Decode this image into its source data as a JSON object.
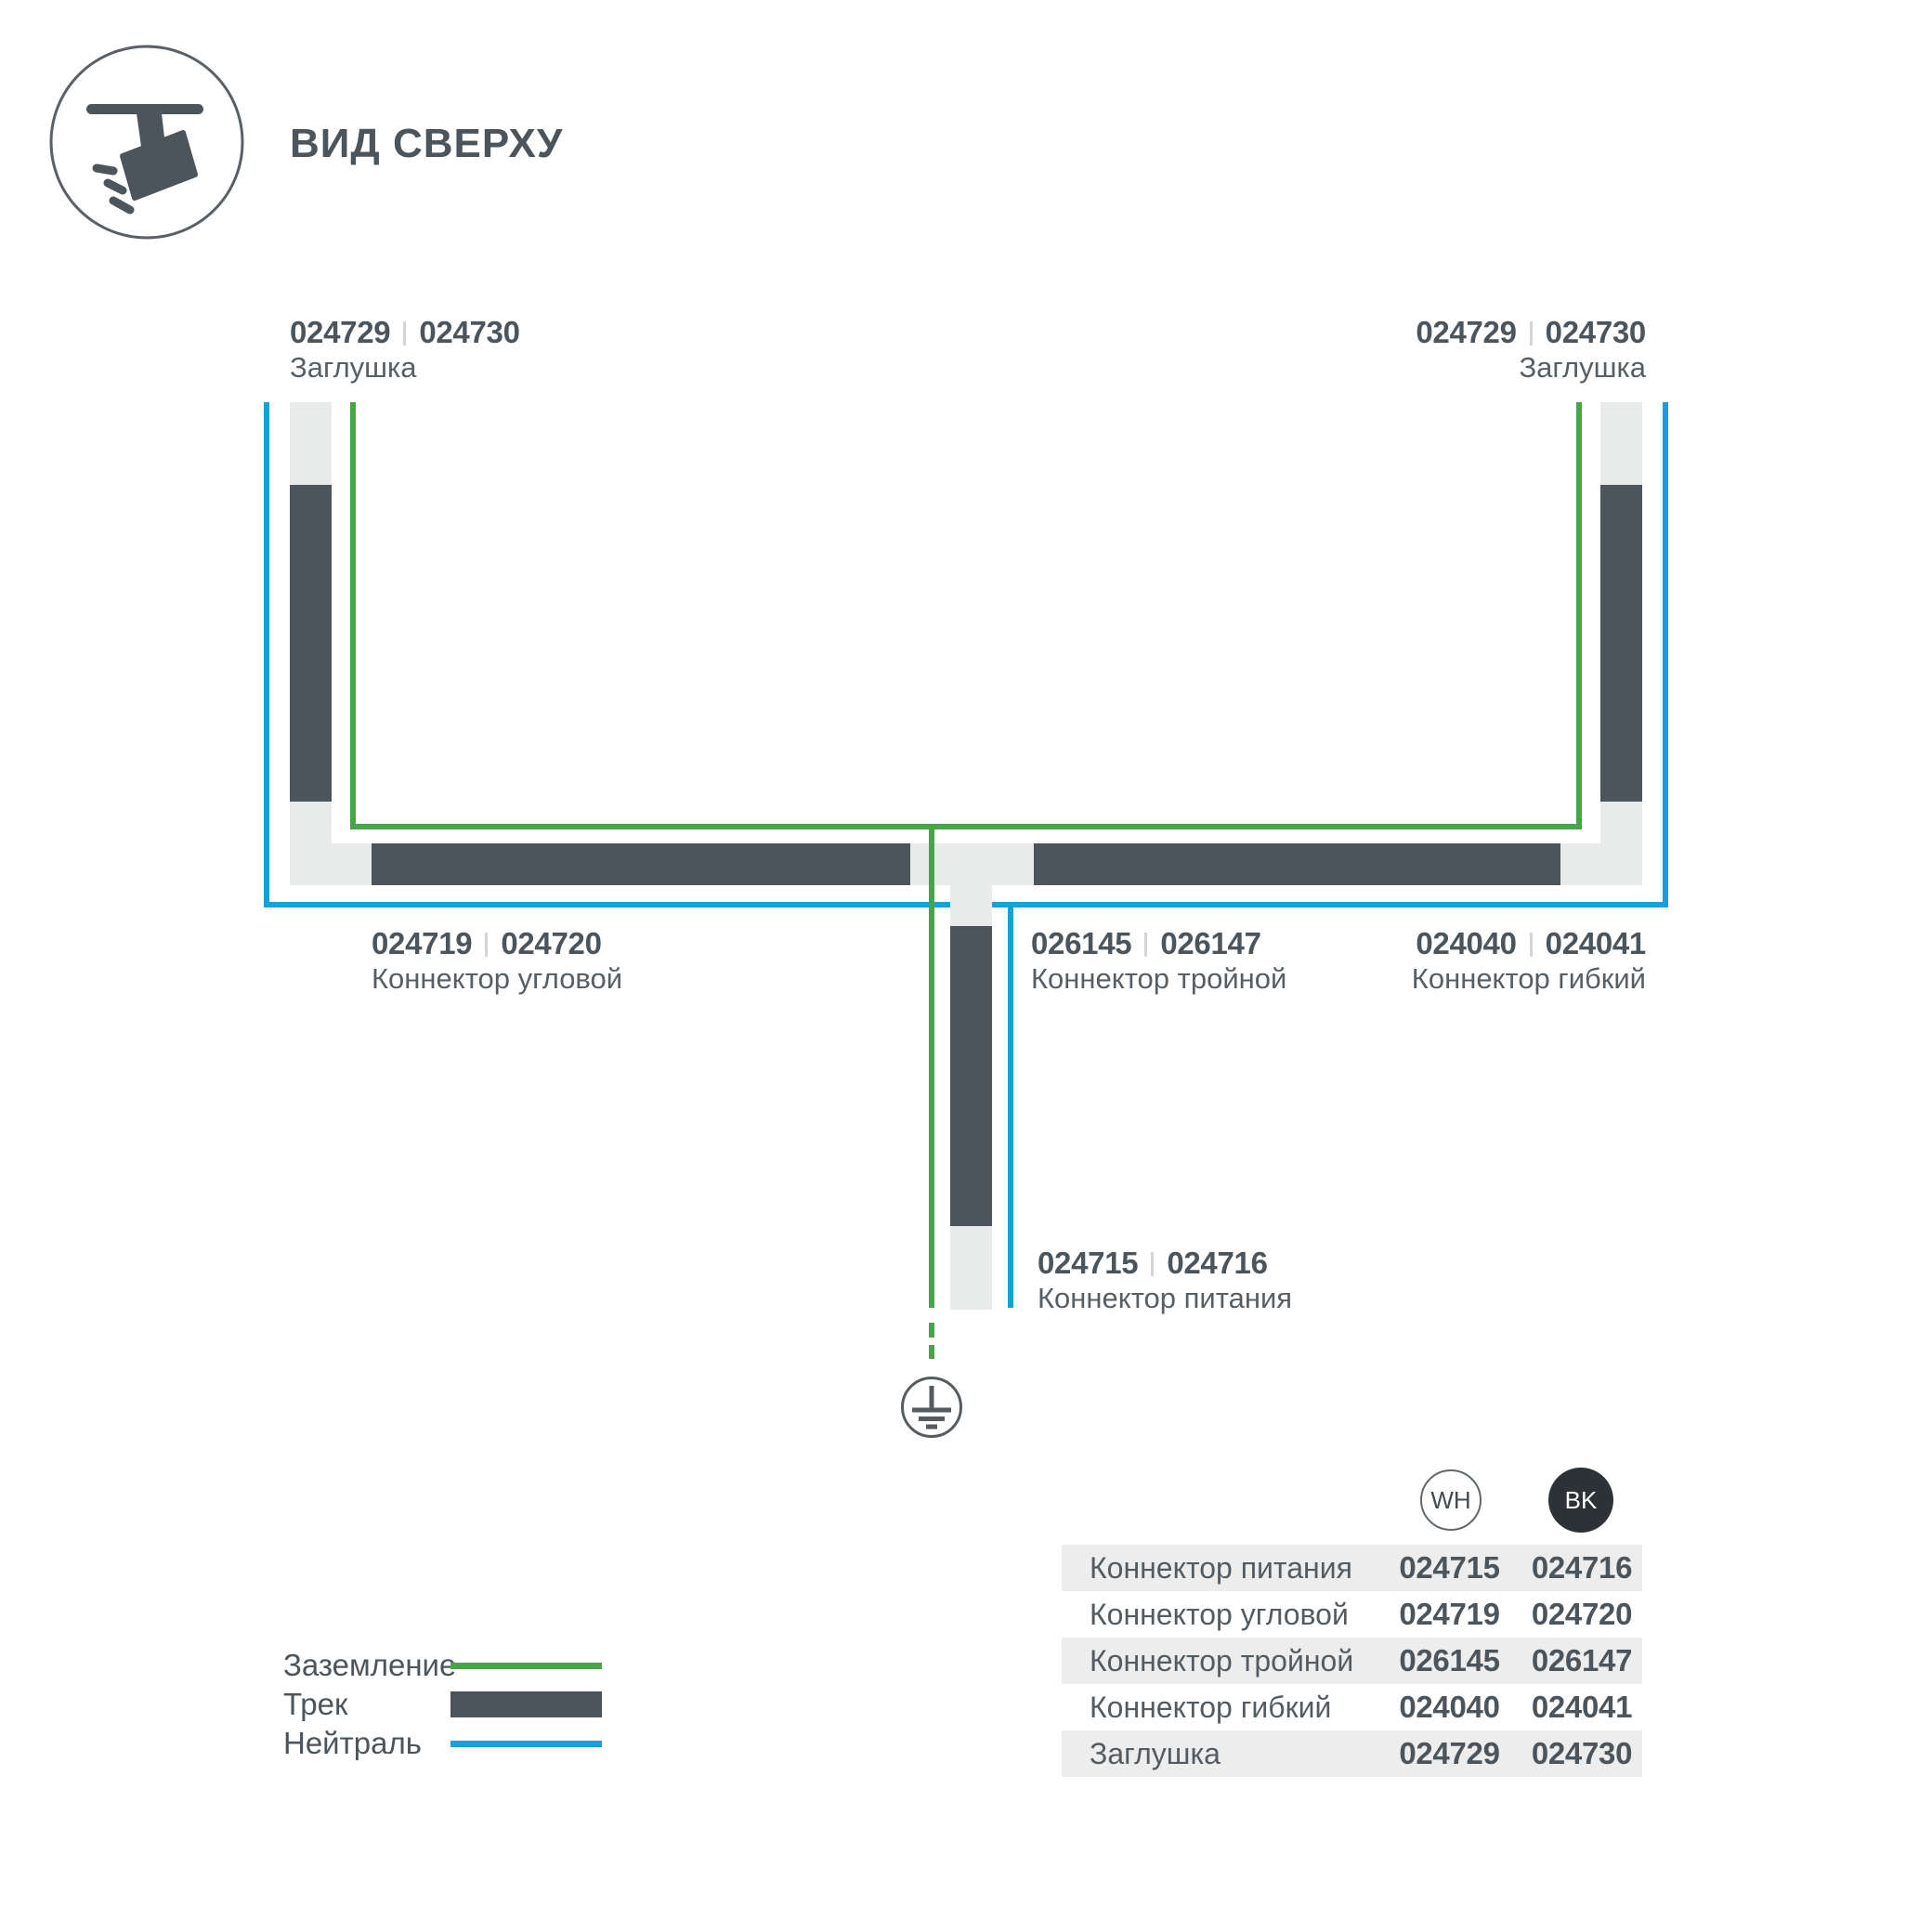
{
  "header": {
    "title": "ВИД СВЕРХУ",
    "icon": "track-spotlight-icon"
  },
  "diagram": {
    "cap_left": {
      "code_wh": "024729",
      "code_bk": "024730",
      "name": "Заглушка"
    },
    "cap_right": {
      "code_wh": "024729",
      "code_bk": "024730",
      "name": "Заглушка"
    },
    "corner": {
      "code_wh": "024719",
      "code_bk": "024720",
      "name": "Коннектор угловой"
    },
    "triple": {
      "code_wh": "026145",
      "code_bk": "026147",
      "name": "Коннектор тройной"
    },
    "flexible": {
      "code_wh": "024040",
      "code_bk": "024041",
      "name": "Коннектор гибкий"
    },
    "power": {
      "code_wh": "024715",
      "code_bk": "024716",
      "name": "Коннектор питания"
    },
    "ground_symbol": "earth-ground-icon"
  },
  "legend": {
    "items": [
      {
        "label": "Заземление",
        "swatch": "green-ground-line"
      },
      {
        "label": "Трек",
        "swatch": "dark-track-bar"
      },
      {
        "label": "Нейтраль",
        "swatch": "blue-neutral-line"
      }
    ]
  },
  "table": {
    "columns": [
      {
        "id": "WH"
      },
      {
        "id": "BK"
      }
    ],
    "rows": [
      {
        "label": "Коннектор питания",
        "wh": "024715",
        "bk": "024716"
      },
      {
        "label": "Коннектор угловой",
        "wh": "024719",
        "bk": "024720"
      },
      {
        "label": "Коннектор тройной",
        "wh": "026145",
        "bk": "026147"
      },
      {
        "label": "Коннектор гибкий",
        "wh": "024040",
        "bk": "024041"
      },
      {
        "label": "Заглушка",
        "wh": "024729",
        "bk": "024730"
      }
    ]
  },
  "colors": {
    "track": "#4d555c",
    "connector": "#e9ebeb",
    "ground_green": "#46a546",
    "neutral_blue": "#18a0dc",
    "table_stripe": "#ecedec",
    "badge_black": "#2d3237"
  }
}
